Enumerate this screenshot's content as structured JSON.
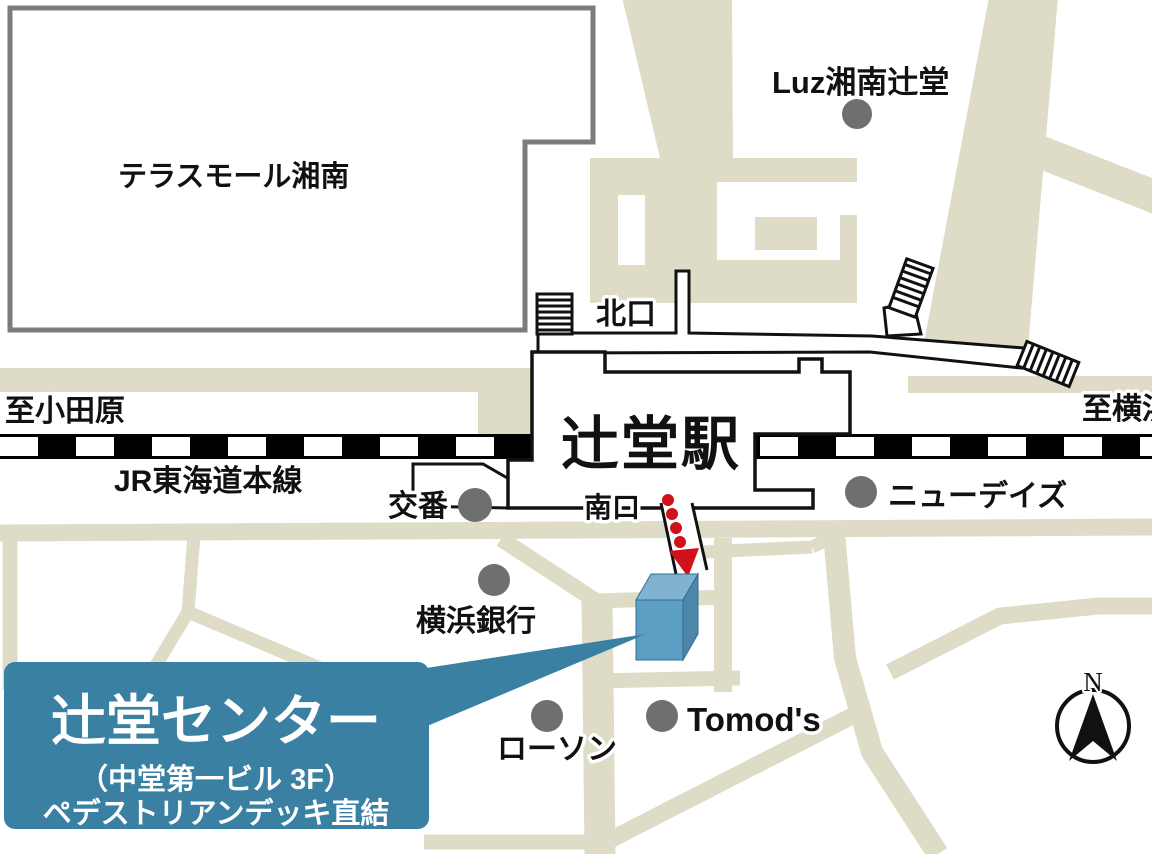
{
  "map": {
    "labels": {
      "terrace_mall": "テラスモール湘南",
      "luz": "Luz湘南辻堂",
      "north_exit": "北口",
      "to_odawara": "至小田原",
      "to_yokohama": "至横浜",
      "station": "辻堂駅",
      "jr_line": "JR東海道本線",
      "koban": "交番",
      "south_exit": "南口",
      "newdays": "ニューデイズ",
      "yokohama_bank": "横浜銀行",
      "lawson": "ローソン",
      "tomods": "Tomod's",
      "compass_north": "N"
    },
    "callout": {
      "title": "辻堂センター",
      "subtitle": "（中堂第一ビル 3F）",
      "note": "ペデストリアンデッキ直結"
    },
    "colors": {
      "road": "#DEDCC7",
      "accent": "#3A80A2",
      "building_top": "#7FB3D0",
      "building_front": "#5C9EC4",
      "building_side": "#4C86A8",
      "arrow_red": "#D0101A",
      "dot_gray": "#6F6F6F",
      "border_gray": "#7C7C7C"
    }
  }
}
